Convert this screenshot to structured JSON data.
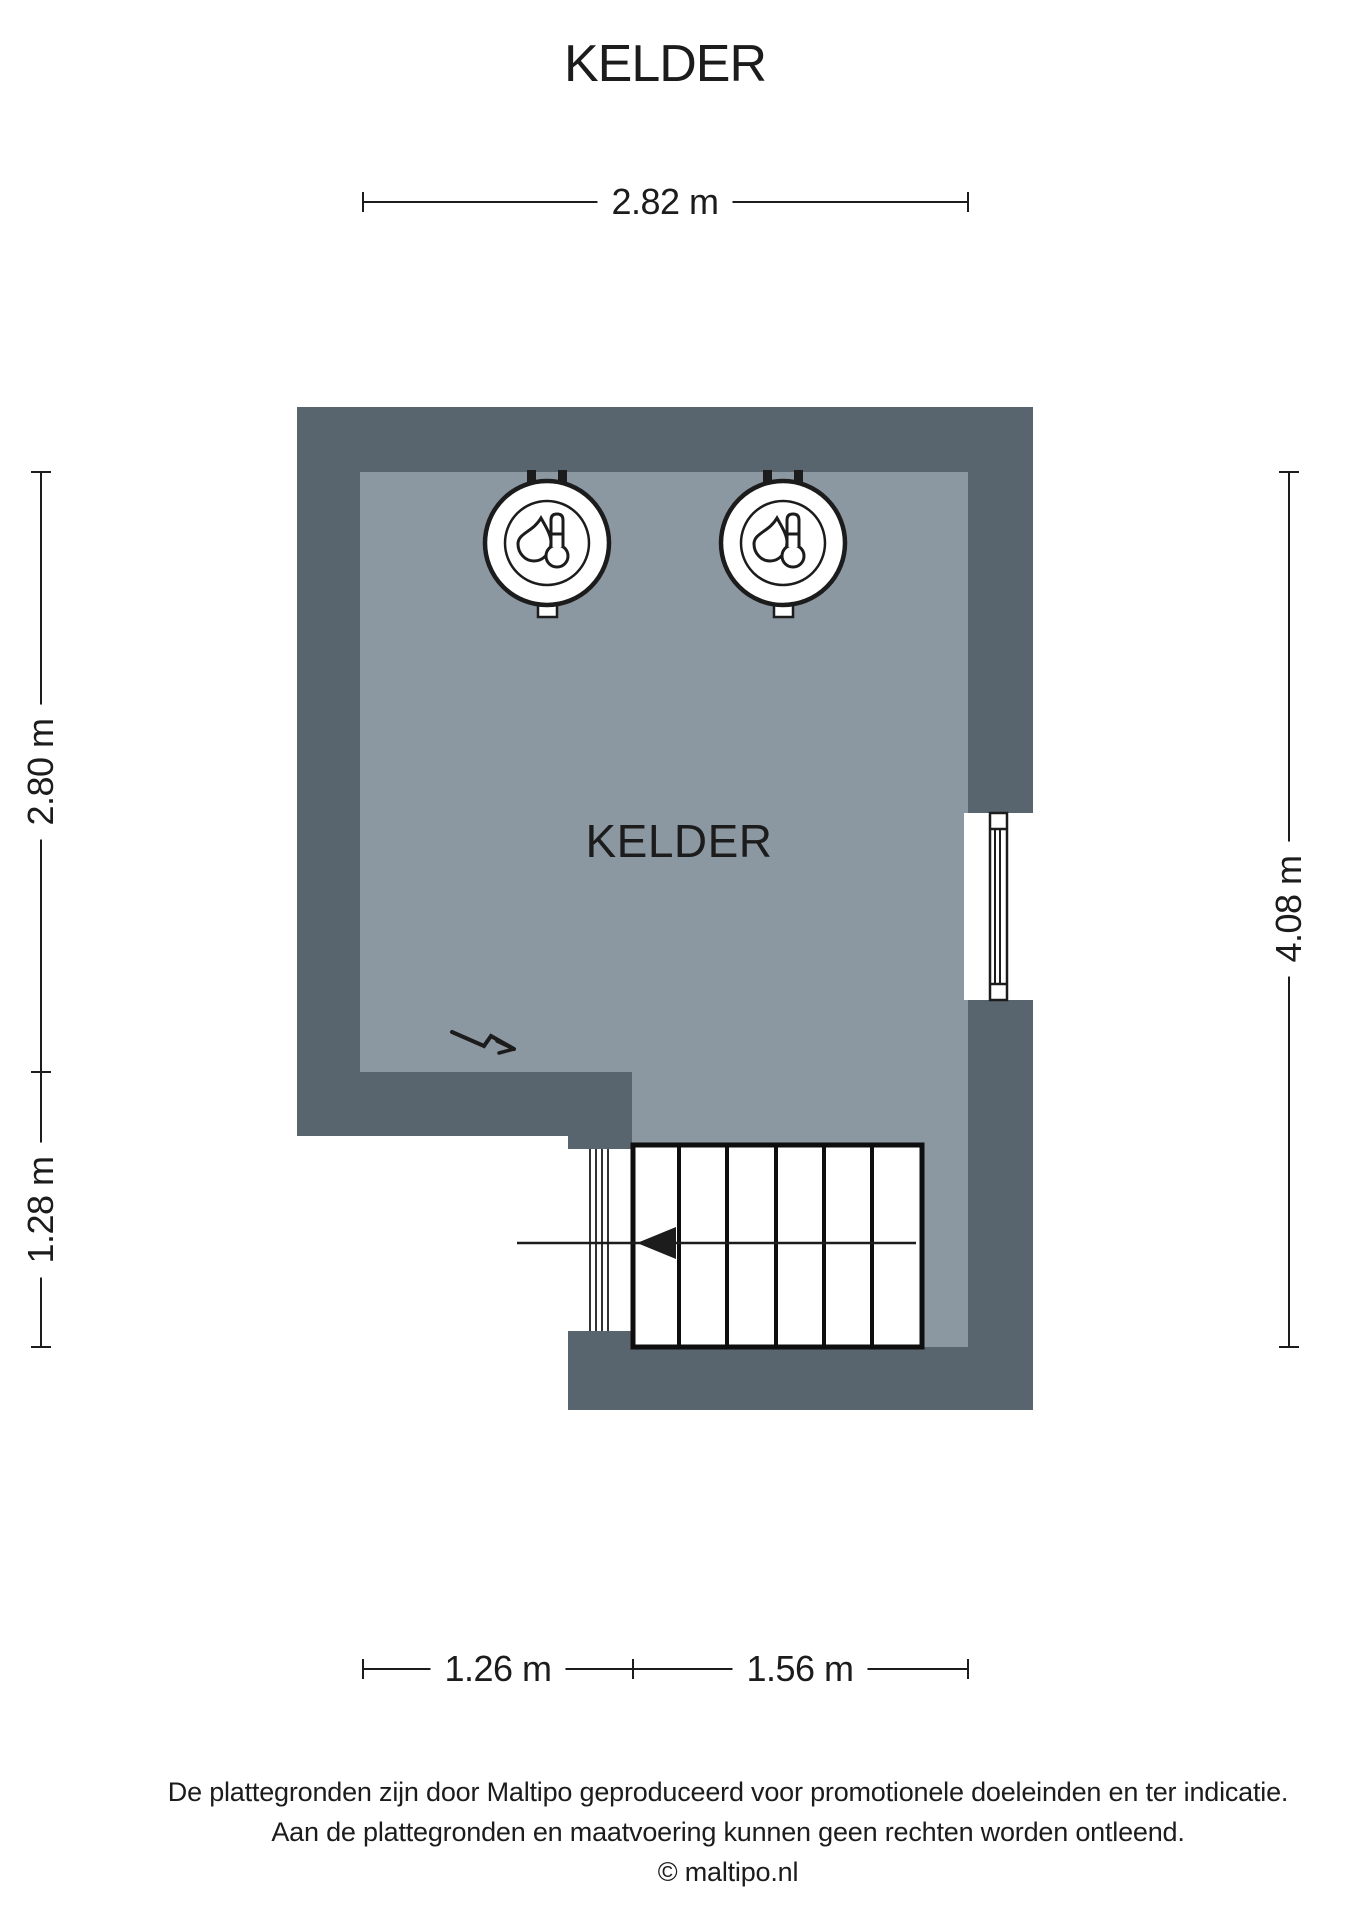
{
  "title": "KELDER",
  "plan": {
    "room_label": "KELDER",
    "dimensions": {
      "top": "2.82 m",
      "left_upper": "2.80 m",
      "left_lower": "1.28 m",
      "right": "4.08 m",
      "bottom_left": "1.26 m",
      "bottom_right": "1.56 m"
    },
    "icons": {
      "boilers": [
        "boiler-thermometer-icon",
        "boiler-thermometer-icon"
      ],
      "electricity": "electricity-zigzag-arrow-icon",
      "stairs_direction": "stairs-direction-arrow-icon"
    }
  },
  "footer": {
    "line1": "De plattegronden zijn door Maltipo geproduceerd voor promotionele doeleinden en ter indicatie.",
    "line2": "Aan de plattegronden en maatvoering kunnen geen rechten worden ontleend.",
    "line3": "© maltipo.nl"
  },
  "colors": {
    "wall": "#59656e",
    "floor": "#8b97a1",
    "ink": "#1c1c1c",
    "white": "#ffffff"
  }
}
